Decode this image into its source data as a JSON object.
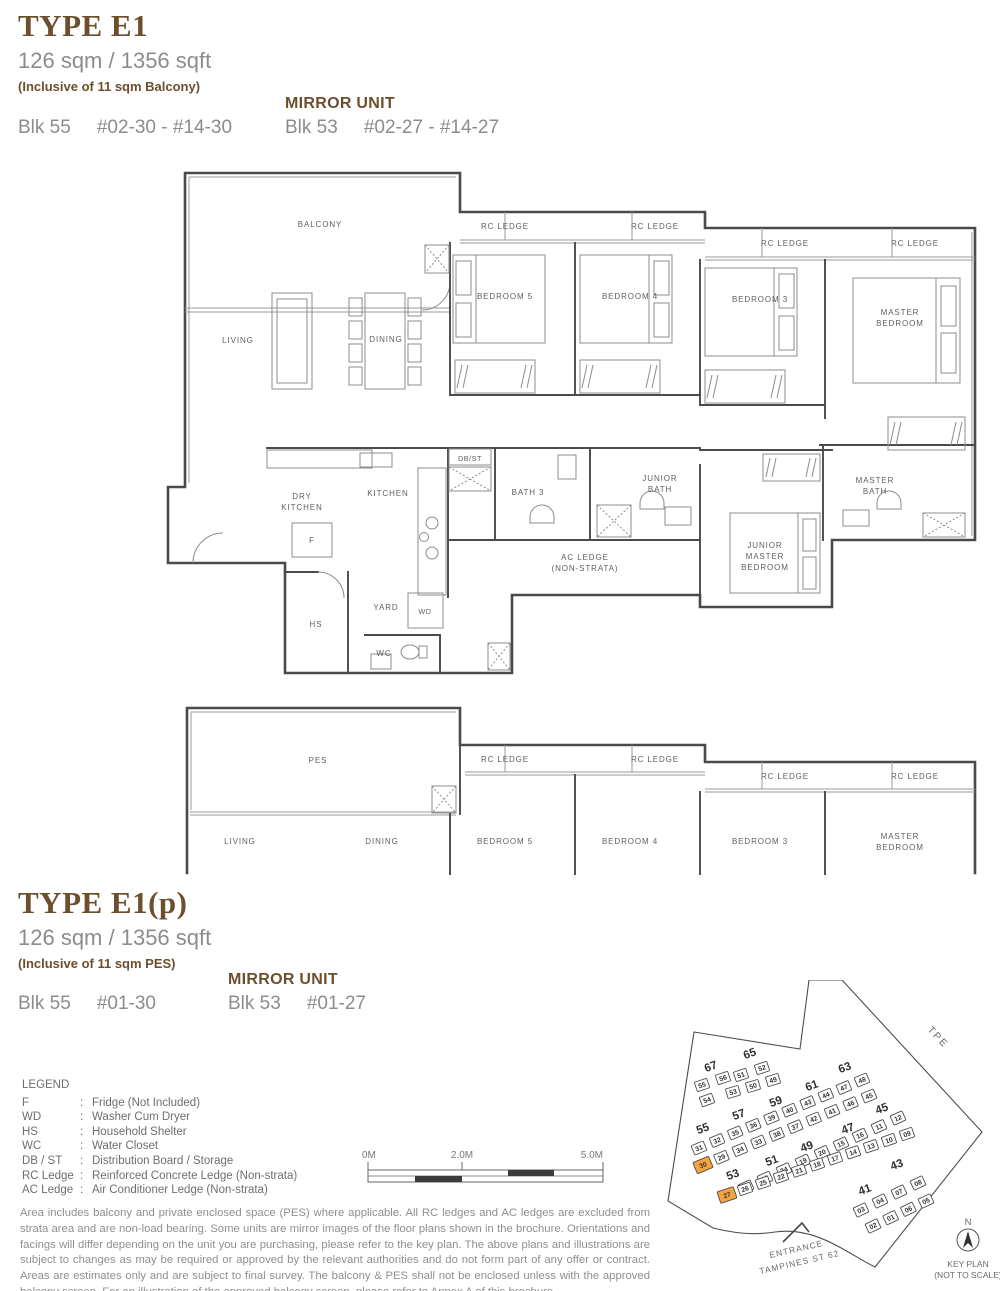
{
  "header1": {
    "type": "TYPE E1",
    "area": "126 sqm / 1356 sqft",
    "note": "(Inclusive of 11 sqm Balcony)",
    "mirror": "MIRROR UNIT",
    "left_blk": "Blk 55",
    "left_units": "#02-30 - #14-30",
    "right_blk": "Blk 53",
    "right_units": "#02-27 - #14-27"
  },
  "header2": {
    "type": "TYPE E1(p)",
    "area": "126 sqm / 1356 sqft",
    "note": "(Inclusive of 11 sqm PES)",
    "mirror": "MIRROR UNIT",
    "left_blk": "Blk 55",
    "left_units": "#01-30",
    "right_blk": "Blk 53",
    "right_units": "#01-27"
  },
  "plan1": {
    "labels": {
      "balcony": "BALCONY",
      "rc_ledge": "RC LEDGE",
      "bedroom5": "BEDROOM 5",
      "bedroom4": "BEDROOM 4",
      "bedroom3": "BEDROOM 3",
      "master_bedroom": [
        "MASTER",
        "BEDROOM"
      ],
      "living": "LIVING",
      "dining": "DINING",
      "dry_kitchen": [
        "DRY",
        "KITCHEN"
      ],
      "kitchen": "KITCHEN",
      "db_st": "DB/ST",
      "bath3": "BATH 3",
      "junior_bath": [
        "JUNIOR",
        "BATH"
      ],
      "ac_ledge": [
        "AC LEDGE",
        "(NON-STRATA)"
      ],
      "junior_master": [
        "JUNIOR",
        "MASTER",
        "BEDROOM"
      ],
      "master_bath": [
        "MASTER",
        "BATH"
      ],
      "f": "F",
      "hs": "HS",
      "yard": "YARD",
      "wd": "WD",
      "wc": "WC"
    }
  },
  "plan2": {
    "labels": {
      "pes": "PES",
      "rc_ledge": "RC LEDGE",
      "living": "LIVING",
      "dining": "DINING",
      "bedroom5": "BEDROOM 5",
      "bedroom4": "BEDROOM 4",
      "bedroom3": "BEDROOM 3",
      "master_bedroom": [
        "MASTER",
        "BEDROOM"
      ]
    }
  },
  "legend": {
    "title": "LEGEND",
    "items": [
      {
        "key": "F",
        "desc": "Fridge (Not Included)"
      },
      {
        "key": "WD",
        "desc": "Washer Cum Dryer"
      },
      {
        "key": "HS",
        "desc": "Household Shelter"
      },
      {
        "key": "WC",
        "desc": "Water Closet"
      },
      {
        "key": "DB / ST",
        "desc": "Distribution Board / Storage"
      },
      {
        "key": "RC Ledge",
        "desc": "Reinforced Concrete Ledge (Non-strata)"
      },
      {
        "key": "AC Ledge",
        "desc": "Air Conditioner Ledge (Non-strata)"
      }
    ]
  },
  "scalebar": {
    "t0": "0M",
    "t1": "2.0M",
    "t2": "5.0M"
  },
  "disclaimer": "Area includes balcony and private enclosed space (PES) where applicable. All RC ledges and AC ledges are excluded from strata area and are non-load bearing. Some units are mirror images of the floor plans shown in the brochure. Orientations and facings will differ depending on the unit you are purchasing, please refer to the key plan. The above plans and illustrations are subject to changes as may be required or approved by the relevant authorities and do not form part of any offer or contract. Areas are estimates only and are subject to final survey. The balcony & PES shall not be enclosed unless with the approved balcony screen. For an illustration of the approved balcony screen, please refer to Annex A of this brochure.",
  "keyplan": {
    "tpe_label": "TPE",
    "entrance": [
      "ENTRANCE",
      "TAMPINES ST 62"
    ],
    "north_label": "N",
    "caption": [
      "KEY PLAN",
      "(NOT TO SCALE)"
    ],
    "highlight_color": "#F5A33F",
    "highlight_units": [
      "30",
      "27"
    ],
    "block_labels": [
      {
        "t": "67",
        "x": 57,
        "y": 90
      },
      {
        "t": "65",
        "x": 96,
        "y": 77
      },
      {
        "t": "55",
        "x": 49,
        "y": 152
      },
      {
        "t": "57",
        "x": 85,
        "y": 138
      },
      {
        "t": "59",
        "x": 122,
        "y": 125
      },
      {
        "t": "61",
        "x": 158,
        "y": 109
      },
      {
        "t": "63",
        "x": 191,
        "y": 91
      },
      {
        "t": "53",
        "x": 79,
        "y": 198
      },
      {
        "t": "51",
        "x": 118,
        "y": 184
      },
      {
        "t": "49",
        "x": 153,
        "y": 170
      },
      {
        "t": "47",
        "x": 194,
        "y": 152
      },
      {
        "t": "45",
        "x": 228,
        "y": 132
      },
      {
        "t": "41",
        "x": 211,
        "y": 213
      },
      {
        "t": "43",
        "x": 243,
        "y": 188
      }
    ],
    "unit_rows": [
      {
        "start": [
          47,
          105
        ],
        "end": [
          68,
          98
        ],
        "units": [
          "55",
          "56"
        ]
      },
      {
        "start": [
          52,
          120
        ],
        "end": [
          52,
          120
        ],
        "units": [
          "54"
        ]
      },
      {
        "start": [
          86,
          95
        ],
        "end": [
          107,
          88
        ],
        "units": [
          "51",
          "52"
        ]
      },
      {
        "start": [
          78,
          112
        ],
        "end": [
          118,
          100
        ],
        "units": [
          "53",
          "50",
          "49"
        ]
      },
      {
        "start": [
          44,
          168
        ],
        "end": [
          207,
          100
        ],
        "units": [
          "31",
          "32",
          "35",
          "36",
          "39",
          "40",
          "43",
          "44",
          "47",
          "48"
        ]
      },
      {
        "start": [
          48,
          185
        ],
        "end": [
          214,
          116
        ],
        "units": [
          "30",
          "29",
          "34",
          "33",
          "38",
          "37",
          "42",
          "41",
          "46",
          "45"
        ]
      },
      {
        "start": [
          91,
          207
        ],
        "end": [
          243,
          138
        ],
        "units": [
          "28",
          "23",
          "24",
          "19",
          "20",
          "15",
          "16",
          "11",
          "12"
        ]
      },
      {
        "start": [
          72,
          215
        ],
        "end": [
          252,
          154
        ],
        "units": [
          "27",
          "26",
          "25",
          "22",
          "21",
          "18",
          "17",
          "14",
          "13",
          "10",
          "09"
        ]
      },
      {
        "start": [
          206,
          230
        ],
        "end": [
          263,
          203
        ],
        "units": [
          "03",
          "04",
          "07",
          "08"
        ]
      },
      {
        "start": [
          218,
          246
        ],
        "end": [
          271,
          221
        ],
        "units": [
          "02",
          "01",
          "06",
          "05"
        ]
      }
    ]
  }
}
